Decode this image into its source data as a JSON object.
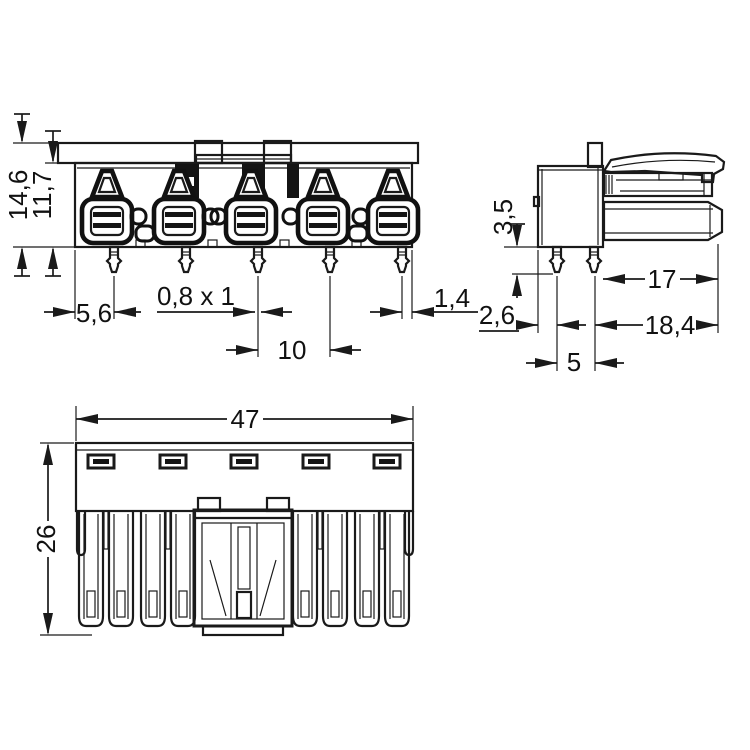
{
  "drawing": {
    "title": "connector-technical-drawing",
    "background": "#ffffff",
    "ink": "#1a1a1a",
    "views": [
      "front",
      "side",
      "bottom"
    ],
    "units_implied": "mm"
  },
  "dims": {
    "front_overall_height": "14,6",
    "front_body_height": "11,7",
    "front_left_edge_to_pin": "5,6",
    "front_pin_cross_section": "0,8 x 1",
    "front_pin_pitch": "10",
    "front_pin_to_right_edge": "1,4",
    "side_pin_shoulder": "3,5",
    "side_edge_to_pin": "2,6",
    "side_plug_length": "17",
    "side_overall_depth": "18,4",
    "side_pin_spacing": "5",
    "bottom_overall_width": "47",
    "bottom_overall_height": "26"
  }
}
